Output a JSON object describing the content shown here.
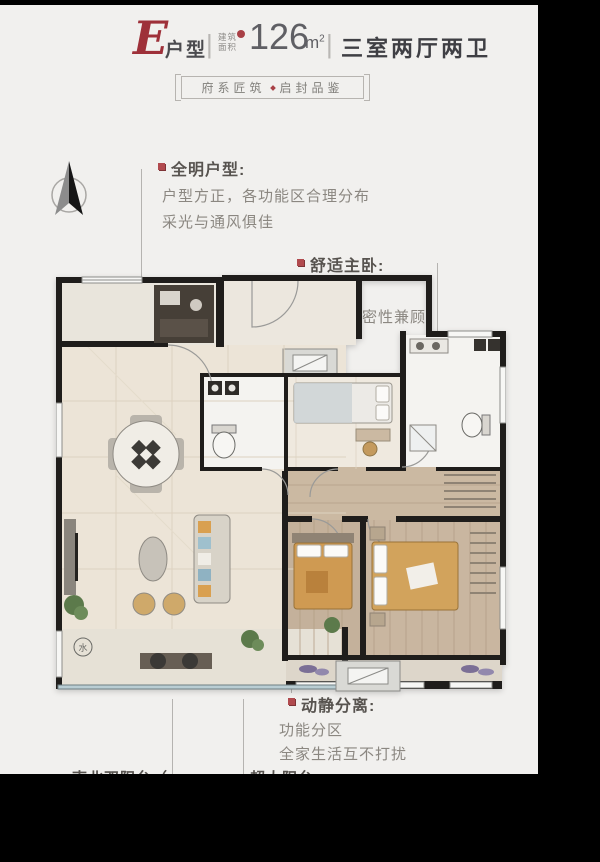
{
  "header": {
    "letter": "E",
    "unit_label": "户型",
    "divider1": "|",
    "area_label_top": "建筑",
    "area_label_bottom": "面积",
    "area_value": "126",
    "area_unit": "m",
    "area_sup": "2",
    "divider2": "|",
    "rooms_label": "三室两厅两卫"
  },
  "badge": {
    "left": "府系匠筑",
    "right": "启封品鉴"
  },
  "annotations": {
    "bright": {
      "title": "全明户型:",
      "line1": "户型方正，各功能区合理分布",
      "line2": "采光与通风俱佳"
    },
    "master": {
      "title": "舒适主卧:",
      "line1": "套房设计",
      "line2": "奢华与私密性兼顾"
    },
    "zones": {
      "title": "动静分离:",
      "line1": "功能分区",
      "line2": "全家生活互不打扰"
    },
    "clipped_left": "南北双阳台（",
    "clipped_right": "超大阳台"
  },
  "floorplan": {
    "water_meter": "水"
  },
  "icons": {
    "compass": "north-arrow-icon",
    "badge_separator": "red-diamond-dot",
    "annotation_bullet": "red-square-bullet"
  },
  "colors": {
    "background": "#f1f0ee",
    "frame": "#000000",
    "accent_red": "#a23a40",
    "wall": "#1f1d1b",
    "leader_line": "#b5b3b0",
    "cream_floor": "#ece4d7",
    "wood_floor": "#c8b59d",
    "tile_floor": "#f4f3f0",
    "bed_tan": "#d2a35c",
    "bed_orange": "#cf9a52"
  }
}
